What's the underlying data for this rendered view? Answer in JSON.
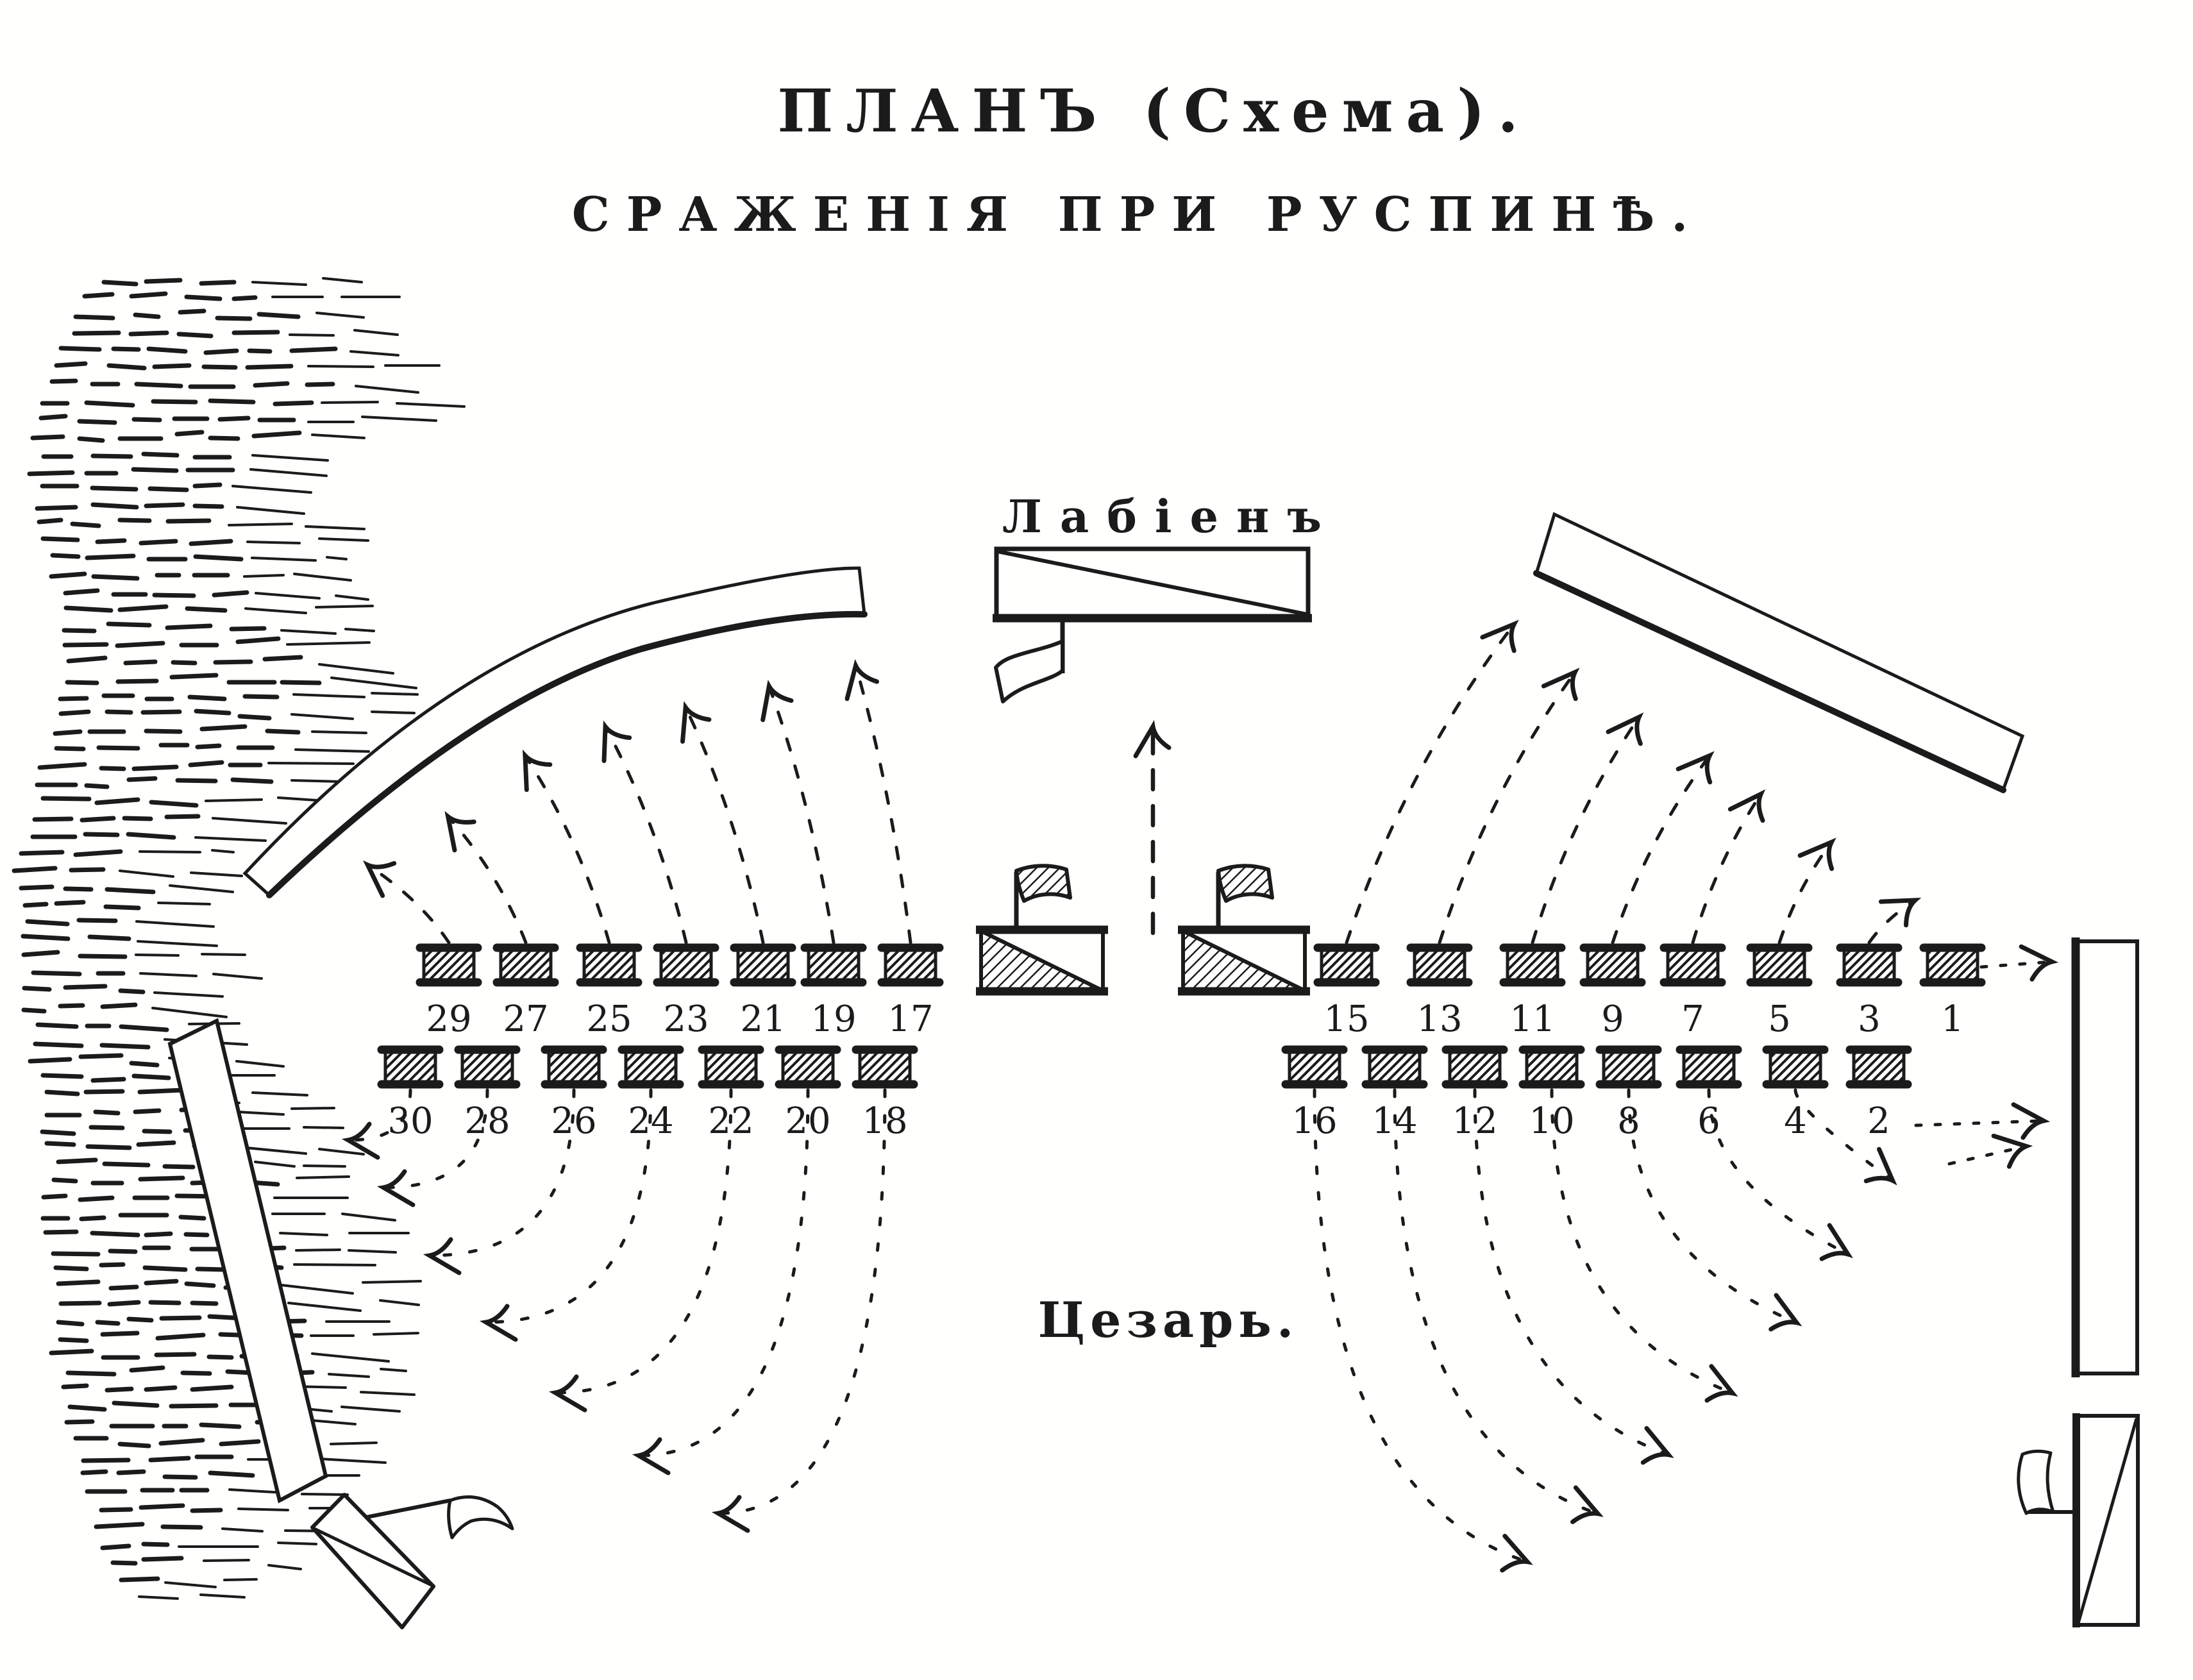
{
  "title": {
    "line1": "ПЛАНЪ (Схема).",
    "line2": "СРАЖЕНІЯ ПРИ РУСПИНѢ."
  },
  "labels": {
    "labienus": "Лабіенъ",
    "caesar": "Цезарь."
  },
  "units": {
    "left_front": [
      "29",
      "27",
      "25",
      "23",
      "21",
      "19",
      "17"
    ],
    "left_rear": [
      "30",
      "28",
      "26",
      "24",
      "22",
      "20",
      "18"
    ],
    "right_front": [
      "15",
      "13",
      "11",
      "9",
      "7",
      "5",
      "3",
      "1"
    ],
    "right_rear": [
      "16",
      "14",
      "12",
      "10",
      "8",
      "6",
      "4",
      "2"
    ]
  },
  "colors": {
    "ink": "#1b1b1b",
    "paper": "#fffffe"
  }
}
